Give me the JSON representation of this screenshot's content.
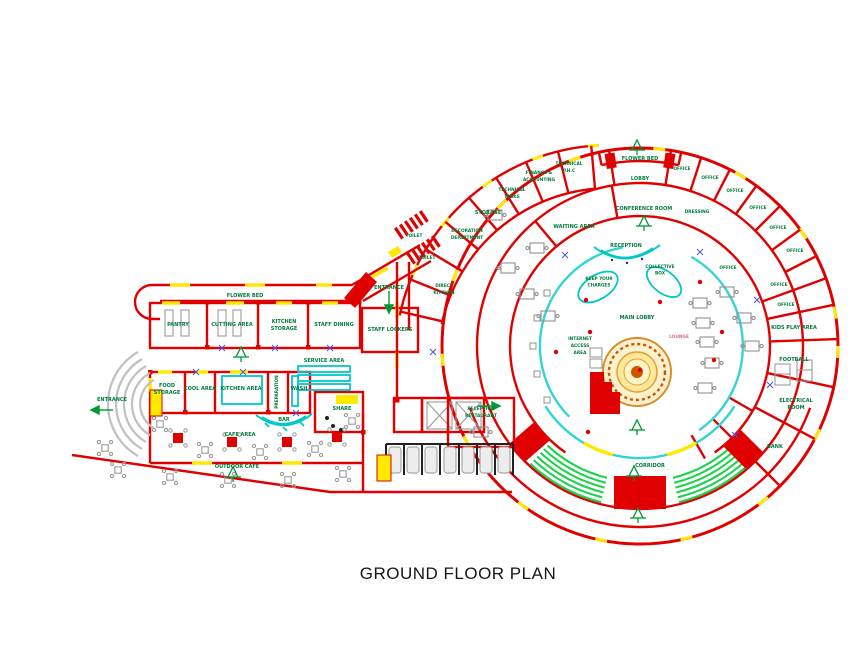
{
  "title": "GROUND FLOOR PLAN",
  "left_wing": {
    "flower_bed": "FLOWER BED",
    "pantry": "PANTRY",
    "cutting_area": "CUTTING AREA",
    "kitchen_storage_l1": "KITCHEN",
    "kitchen_storage_l2": "STORAGE",
    "staff_dining": "STAFF DINING",
    "staff_lockers": "STAFF LOCKERS",
    "service_area": "SERVICE AREA",
    "food_storage_l1": "FOOD",
    "food_storage_l2": "STORAGE",
    "cool_area": "COOL AREA",
    "kitchen_area": "KITCHEN AREA",
    "preparation": "PREPARATION",
    "wash": "WASH",
    "share": "SHARE",
    "bar": "BAR",
    "cafe_area": "CAFE AREA",
    "outdoor_cafe": "OUTDOOR CAFE",
    "entrance_side": "ENTRANCE",
    "entrance_top": "ENTRANCE"
  },
  "rotunda": {
    "flower_bed": "FLOWER BED",
    "lobby": "LOBBY",
    "conference_room": "CONFERENCE ROOM",
    "dressing": "DRESSING",
    "offices": [
      "OFFICE",
      "OFFICE",
      "OFFICE",
      "OFFICE",
      "OFFICE",
      "OFFICE",
      "OFFICE",
      "OFFICE",
      "OFFICE"
    ],
    "kids_play_area": "KIDS PLAY AREA",
    "football": "FOOTBALL",
    "electrical_l1": "ELECTRICAL",
    "electrical_l2": "ROOM",
    "bank": "BANK",
    "finance_l1": "FINANCE &",
    "finance_l2": "ACCOUNTING",
    "technical_phc_l1": "TECHNICAL",
    "technical_phc_l2": "P.H.C",
    "technical_tasks_l1": "TECHNICAL",
    "technical_tasks_l2": "TASKS",
    "storage": "STORAGE",
    "decoration_l1": "DECORATION",
    "decoration_l2": "DEPARTMENT",
    "toilets": [
      "TOILET",
      "TOILET"
    ],
    "direct_kitchen_l1": "DIRECT",
    "direct_kitchen_l2": "KITCHEN",
    "waiting_area": "WAITING AREA",
    "reception": "RECEPTION",
    "collective_l1": "COLLECTIVE",
    "collective_l2": "BOX",
    "charges_l1": "KEEP YOUR",
    "charges_l2": "CHARGES",
    "main_lobby": "MAIN LOBBY",
    "lounge": "LOUNGE",
    "internet_l1": "INTERNET",
    "internet_l2": "ACCESS",
    "internet_l3": "AREA",
    "corridor": "CORRIDOR",
    "reception_restaurant_l1": "RECEPTION",
    "reception_restaurant_l2": "RESTAURANT"
  },
  "colors": {
    "wall": "#e00000",
    "window": "#ffe900",
    "label": "#007c3a",
    "water": "#00c8c8",
    "stairs": "#1fd24e",
    "fountain": "#e89a2f"
  }
}
